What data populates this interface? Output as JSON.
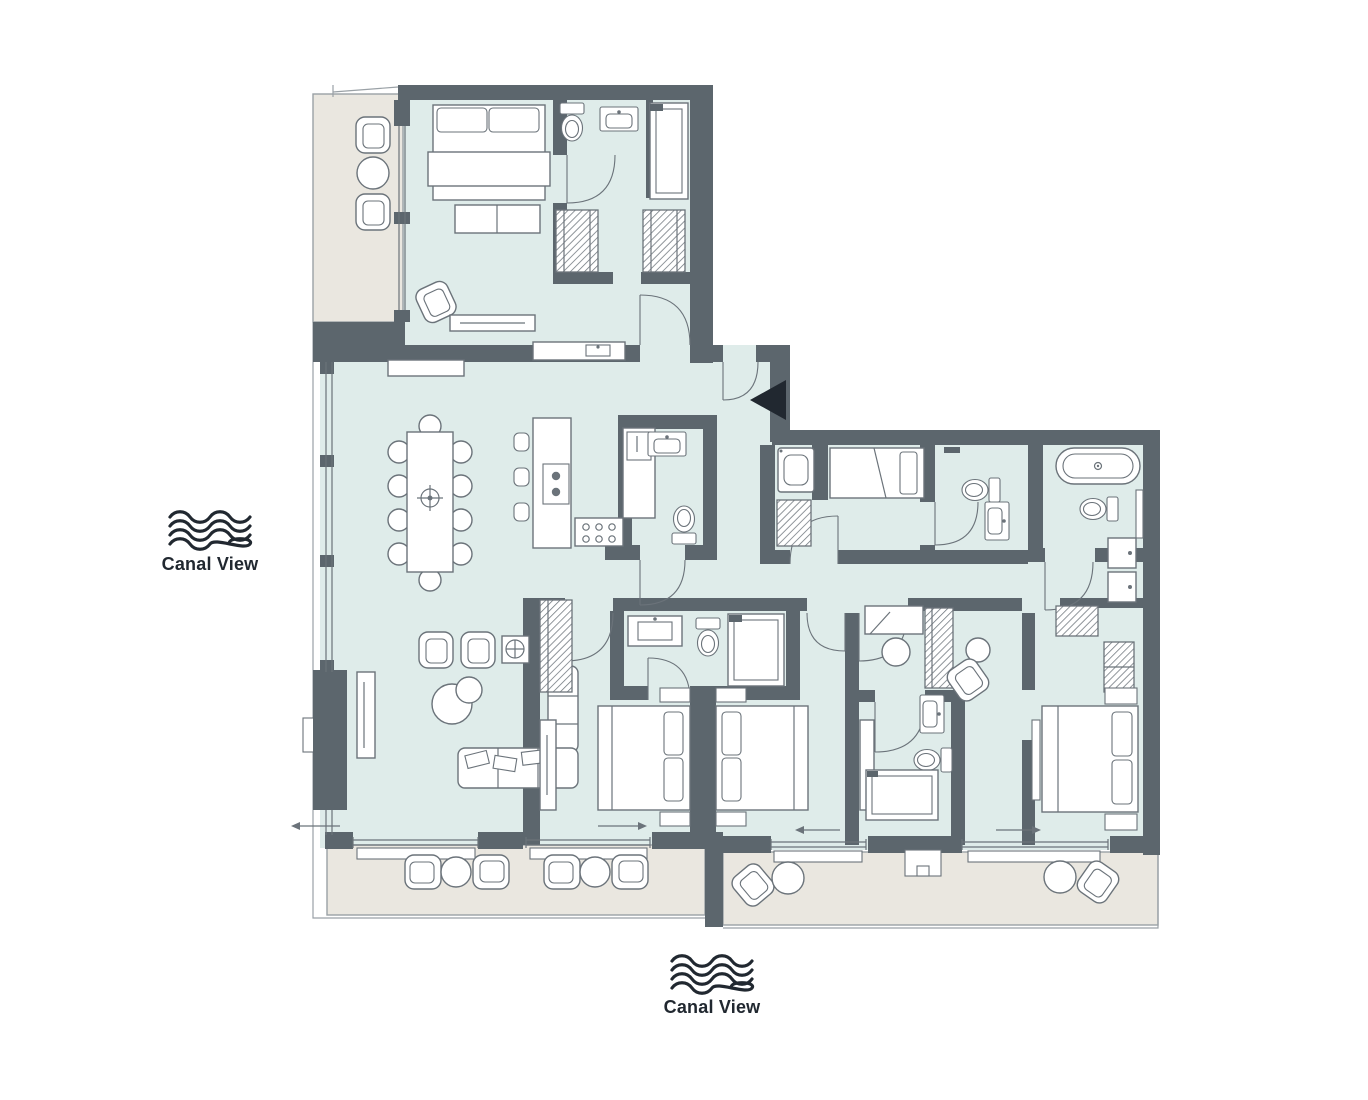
{
  "labels": {
    "canal_view_left": "Canal View",
    "canal_view_bottom": "Canal View"
  },
  "icons": {
    "left_view_icon": "canal-waves-icon",
    "bottom_view_icon": "canal-waves-icon",
    "entry_marker": "entry-arrow-icon"
  },
  "colors": {
    "wall": "#5c666d",
    "room": "#dfecea",
    "balcony": "#eae7e0",
    "outline": "#9aa1a6",
    "line": "#6b737a",
    "ink": "#212830",
    "white": "#ffffff"
  }
}
